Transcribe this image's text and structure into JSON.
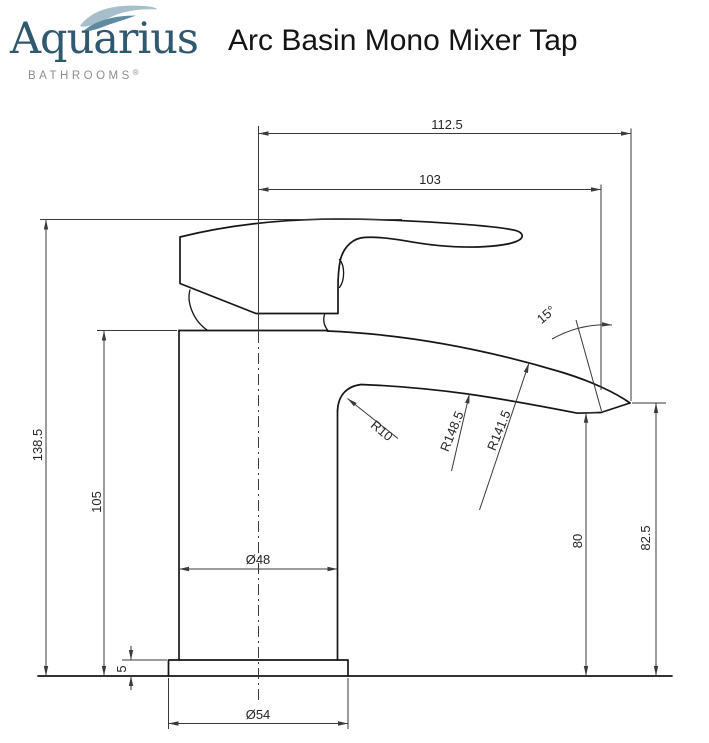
{
  "header": {
    "brand": {
      "name": "Aquarius",
      "tagline": "BATHROOMS",
      "registered": "®"
    },
    "title": "Arc Basin Mono Mixer Tap"
  },
  "drawing": {
    "dimensions": {
      "width_overall": "112.5",
      "width_to_outlet": "103",
      "height_overall": "138.5",
      "height_body": "105",
      "base_thickness": "5",
      "height_outlet": "80",
      "height_spout_tip": "82.5",
      "body_diameter": "Ø48",
      "base_diameter": "Ø54",
      "spout_angle": "15°",
      "spout_fillet_radius": "R10",
      "spout_under_radius": "R148.5",
      "spout_top_radius": "R141.5"
    }
  },
  "colors": {
    "brand_text": "#30586f",
    "wave_light": "#a6bfca",
    "wave_dark": "#5f8ba0",
    "tagline_gray": "#8e8e8e",
    "outline_dark": "#161616",
    "dimension_gray": "#3a3a3a"
  }
}
